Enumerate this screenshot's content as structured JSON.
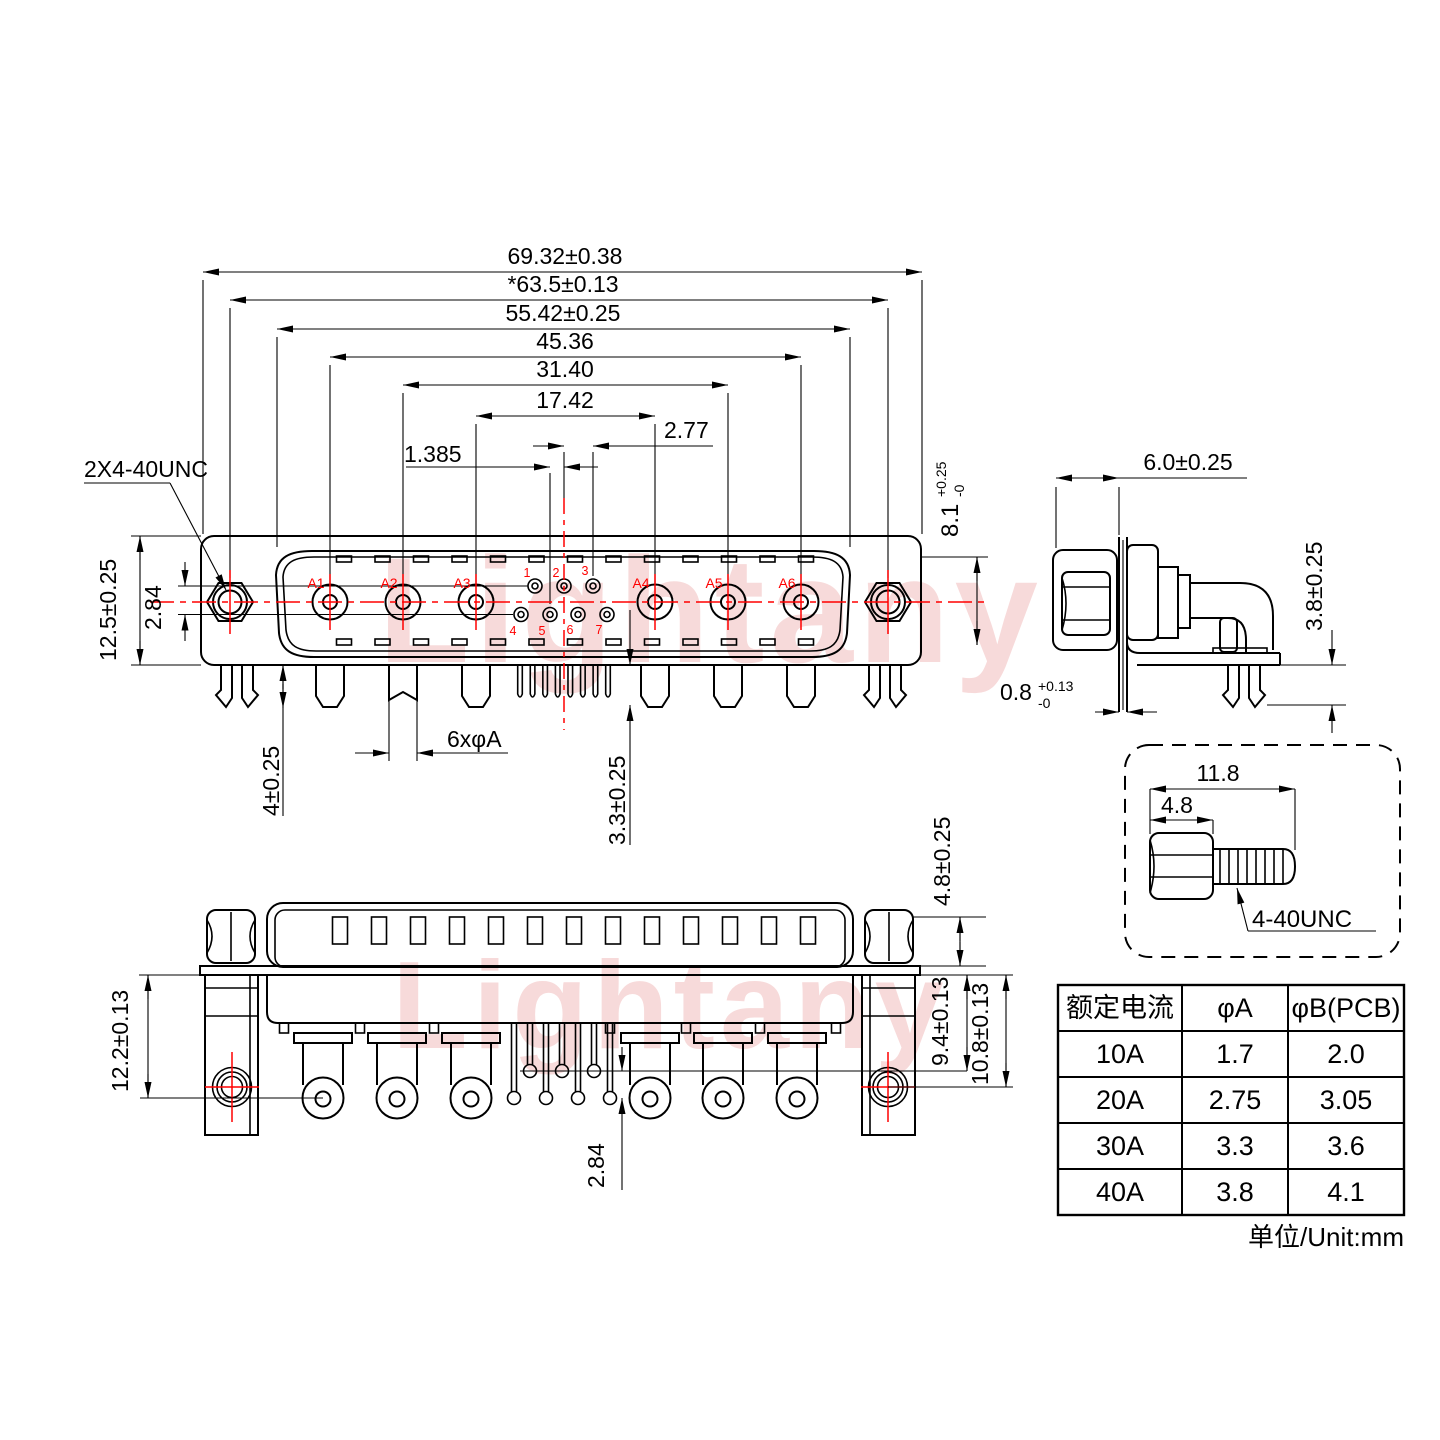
{
  "watermark": {
    "text": "Lightany"
  },
  "top_view": {
    "width_dims": [
      "69.32±0.38",
      "*63.5±0.13",
      "55.42±0.25",
      "45.36",
      "31.40",
      "17.42"
    ],
    "pitch_dim": "2.77",
    "half_pitch_dim": "1.385",
    "screw_note": "2X4-40UNC",
    "flange_height": "12.5±0.25",
    "row_offset": "2.84",
    "shell_depth": {
      "value": "8.1",
      "tol_plus": "+0.25",
      "tol_minus": "-0"
    },
    "clip_len": "4±0.25",
    "pin_dia": "6xφA",
    "pin_len": "3.3±0.25",
    "coax_labels": [
      "A1",
      "A2",
      "A3",
      "A4",
      "A5",
      "A6"
    ],
    "pin_numbers": [
      "1",
      "2",
      "3",
      "4",
      "5",
      "6",
      "7"
    ]
  },
  "side_view": {
    "depth": "6.0±0.25",
    "bracket_height": "3.8±0.25",
    "flange_thickness": {
      "value": "0.8",
      "tol_plus": "+0.13",
      "tol_minus": "-0"
    }
  },
  "bottom_view": {
    "body_height": "12.2±0.13",
    "nut_height": "4.8±0.25",
    "pin_row1": "9.4±0.13",
    "pin_row2": "10.8±0.13",
    "row_offset": "2.84"
  },
  "screw_detail": {
    "total_len": "11.8",
    "head_len": "4.8",
    "thread": "4-40UNC"
  },
  "spec_table": {
    "headers": [
      "额定电流",
      "φA",
      "φB(PCB)"
    ],
    "rows": [
      [
        "10A",
        "1.7",
        "2.0"
      ],
      [
        "20A",
        "2.75",
        "3.05"
      ],
      [
        "30A",
        "3.3",
        "3.6"
      ],
      [
        "40A",
        "3.8",
        "4.1"
      ]
    ],
    "unit_note": "单位/Unit:mm"
  },
  "colors": {
    "line": "#000000",
    "accent": "#ff0000",
    "watermark": "#f2bcbc"
  }
}
